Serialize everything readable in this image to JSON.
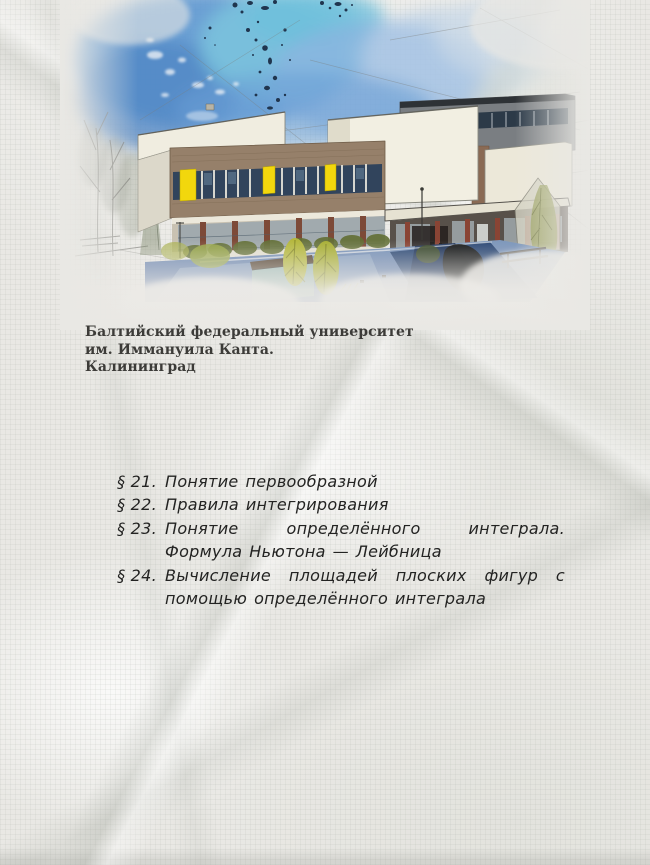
{
  "page": {
    "background_color": "#e9e8e4",
    "texture": "crumpled graph paper"
  },
  "illustration": {
    "description": "Акварельный рисунок главного корпуса университета",
    "colors": {
      "sky_blue": "#5d97d2",
      "sky_cyan": "#7cc6de",
      "ink_splatter": "#20354e",
      "wall_white": "#f1eee2",
      "brick_brown": "#96806a",
      "window_dark": "#31445c",
      "accent_yellow": "#f2d70d",
      "column_red": "#7d4a38",
      "plaza_blue": "#49689a",
      "bush_green": "#b5b83e"
    }
  },
  "caption": {
    "lines": [
      "Балтийский федеральный университет",
      "им. Иммануила Канта.",
      "Калининград"
    ]
  },
  "toc": {
    "items": [
      {
        "number": "§ 21.",
        "title": "Понятие первообразной"
      },
      {
        "number": "§ 22.",
        "title": "Правила интегрирования"
      },
      {
        "number": "§ 23.",
        "title": "Понятие определённого интеграла. Формула Ньютона — Лейбница"
      },
      {
        "number": "§ 24.",
        "title": "Вычисление площадей плоских фигур с помощью определённого интеграла"
      }
    ]
  }
}
